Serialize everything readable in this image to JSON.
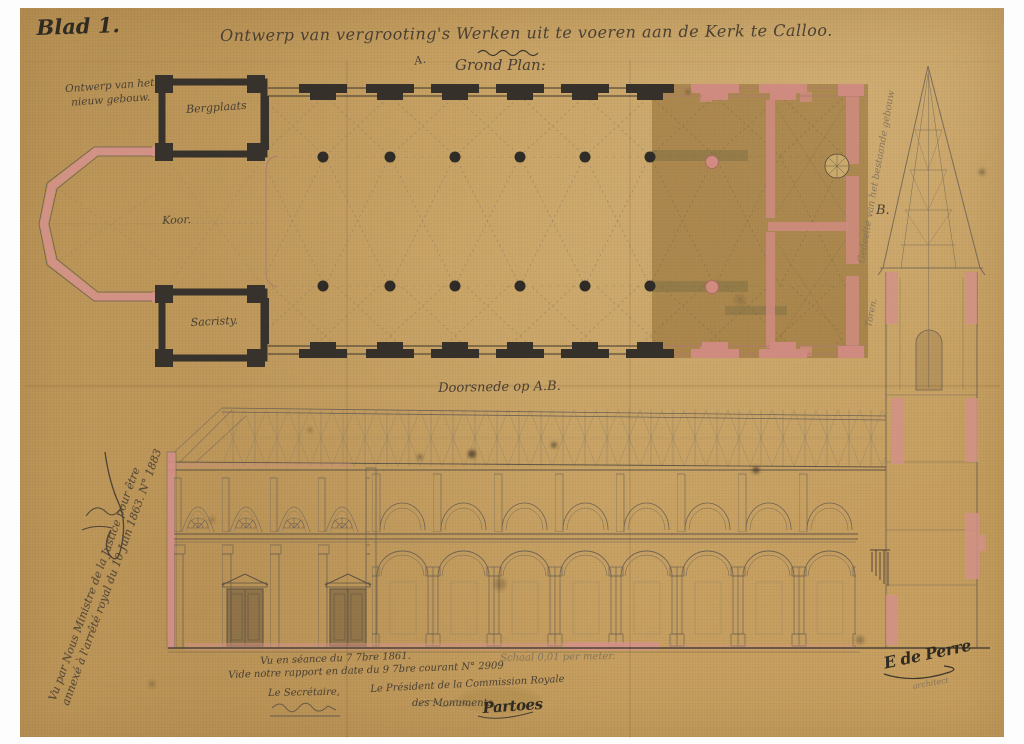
{
  "colors": {
    "paper": "#c7a061",
    "existing_building_patch": "#a37f42",
    "wall_ink": "#332d25",
    "handwriting_ink": "#4a4033",
    "faint_ink": "#86755a",
    "pink_wash": "#d4918a",
    "drawing_line": "#6f6252"
  },
  "header": {
    "sheet_label": "Blad 1.",
    "title": "Ontwerp van vergrooting's Werken uit te voeren aan de Kerk te Calloo.",
    "plan_label": "Grond Plan:",
    "section_marker_top": "A."
  },
  "plan": {
    "new_building_note": "Ontwerp van het nieuw gebouw.",
    "rooms": {
      "bergplaats": "Bergplaats",
      "koor": "Koor.",
      "sacristy": "Sacristy."
    },
    "section_marker_right": "B.",
    "existing_note": "Gedeelte van het bestaande gebouw",
    "tower_note": "Toren."
  },
  "section": {
    "label": "Doorsnede op A.B.",
    "scale_note": "Schaal 0,01 per meter."
  },
  "approvals": {
    "minister_line1": "Vu par Nous Ministre de la Justice pour être",
    "minister_line2": "annexé à l'arrêté royal du 10 Juin 1863. N° 1883",
    "commission": {
      "seance": "Vu en séance du 7 7bre 1861.",
      "rapport": "Vide notre rapport en date du 9 7bre courant N° 2909",
      "secretary_label": "Le Secrétaire,",
      "president_label_1": "Le Président de la Commission Royale",
      "president_label_2": "des Monuments,",
      "president_signature": "Partoes"
    },
    "architect": {
      "signature": "E de Perre",
      "title": "architect"
    }
  }
}
